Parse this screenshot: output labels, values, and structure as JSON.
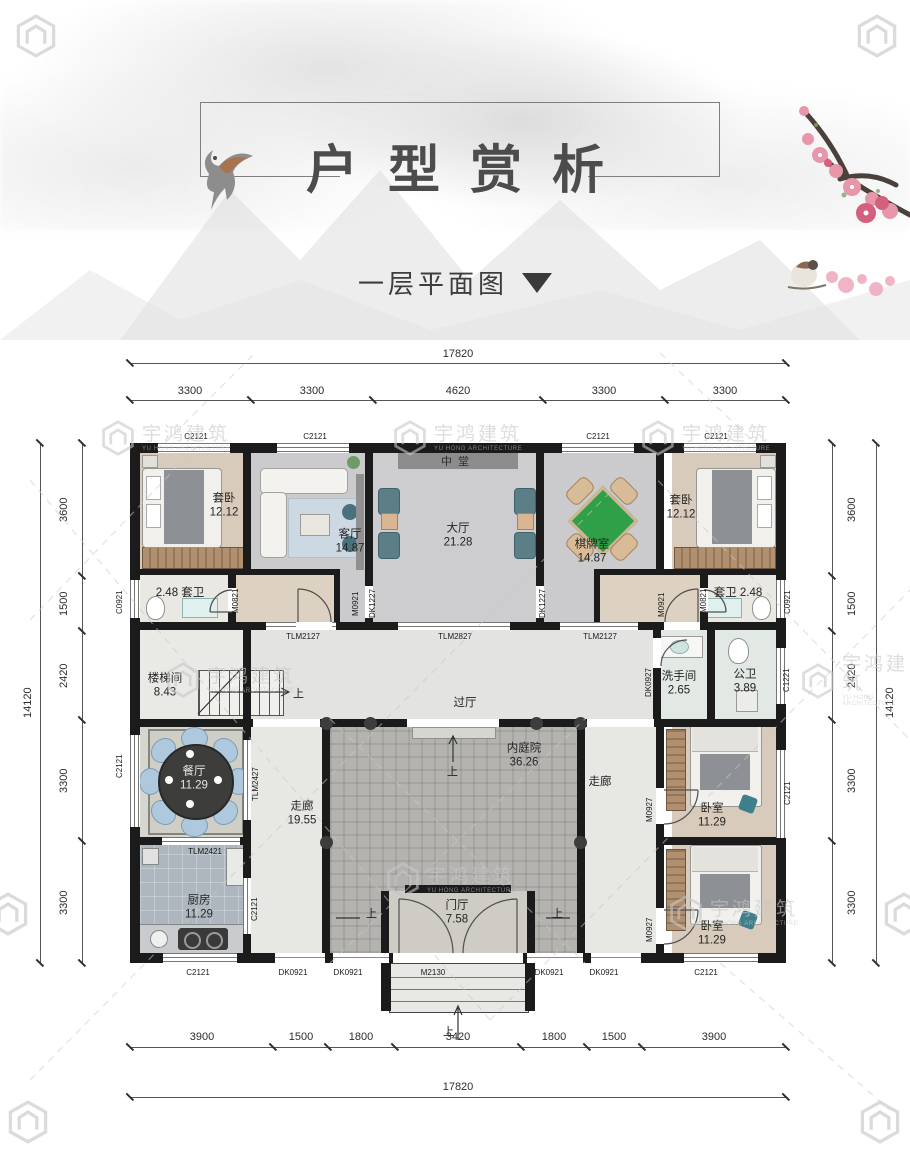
{
  "header": {
    "title": "户型赏析",
    "subtitle": "一层平面图"
  },
  "watermark": {
    "cn": "宇鸿建筑",
    "en": "YU HONG ARCHITECTURE"
  },
  "dimensions": {
    "top_total": "17820",
    "top_segments": [
      "3300",
      "3300",
      "4620",
      "3300",
      "3300"
    ],
    "bottom_segments": [
      "3900",
      "1500",
      "1800",
      "3420",
      "1800",
      "1500",
      "3900"
    ],
    "bottom_total": "17820",
    "left_total": "14120",
    "left_segments": [
      "3600",
      "1500",
      "2420",
      "3300",
      "3300"
    ],
    "right_total": "14120",
    "right_segments": [
      "3600",
      "1500",
      "2420",
      "3300",
      "3300"
    ]
  },
  "rooms": {
    "hall_plaque": "中堂",
    "suite_bedroom_left": {
      "name": "套卧",
      "area": "12.12"
    },
    "living": {
      "name": "客厅",
      "area": "14.87"
    },
    "hall": {
      "name": "大厅",
      "area": "21.28"
    },
    "chess": {
      "name": "棋牌室",
      "area": "14.87"
    },
    "suite_bedroom_right": {
      "name": "套卧",
      "area": "12.12"
    },
    "suite_bath_left": {
      "name": "套卫",
      "area": "2.48"
    },
    "suite_bath_right": {
      "name": "套卫",
      "area": "2.48"
    },
    "stair": {
      "name": "楼梯间",
      "area": "8.43"
    },
    "passage": {
      "name": "过厅"
    },
    "washroom": {
      "name": "洗手间",
      "area": "2.65"
    },
    "public_bath": {
      "name": "公卫",
      "area": "3.89"
    },
    "dining": {
      "name": "餐厅",
      "area": "11.29"
    },
    "corridor_left": {
      "name": "走廊",
      "area": "19.55"
    },
    "courtyard": {
      "name": "内庭院",
      "area": "36.26"
    },
    "corridor_right": {
      "name": "走廊"
    },
    "bedroom_right_top": {
      "name": "卧室",
      "area": "11.29"
    },
    "bedroom_right_bottom": {
      "name": "卧室",
      "area": "11.29"
    },
    "kitchen": {
      "name": "厨房",
      "area": "11.29"
    },
    "foyer": {
      "name": "门厅",
      "area": "7.58"
    }
  },
  "openings": {
    "c2121": "C2121",
    "c0921": "C0921",
    "c1221": "C1221",
    "m0821": "M0821",
    "m0921": "M0921",
    "m0927": "M0927",
    "m2130": "M2130",
    "dk1227": "DK1227",
    "dk0927": "DK0927",
    "dk0921": "DK0921",
    "tlm2127": "TLM2127",
    "tlm2827": "TLM2827",
    "tlm2421": "TLM2421",
    "tlm2427": "TLM2427"
  },
  "up_label": "上"
}
